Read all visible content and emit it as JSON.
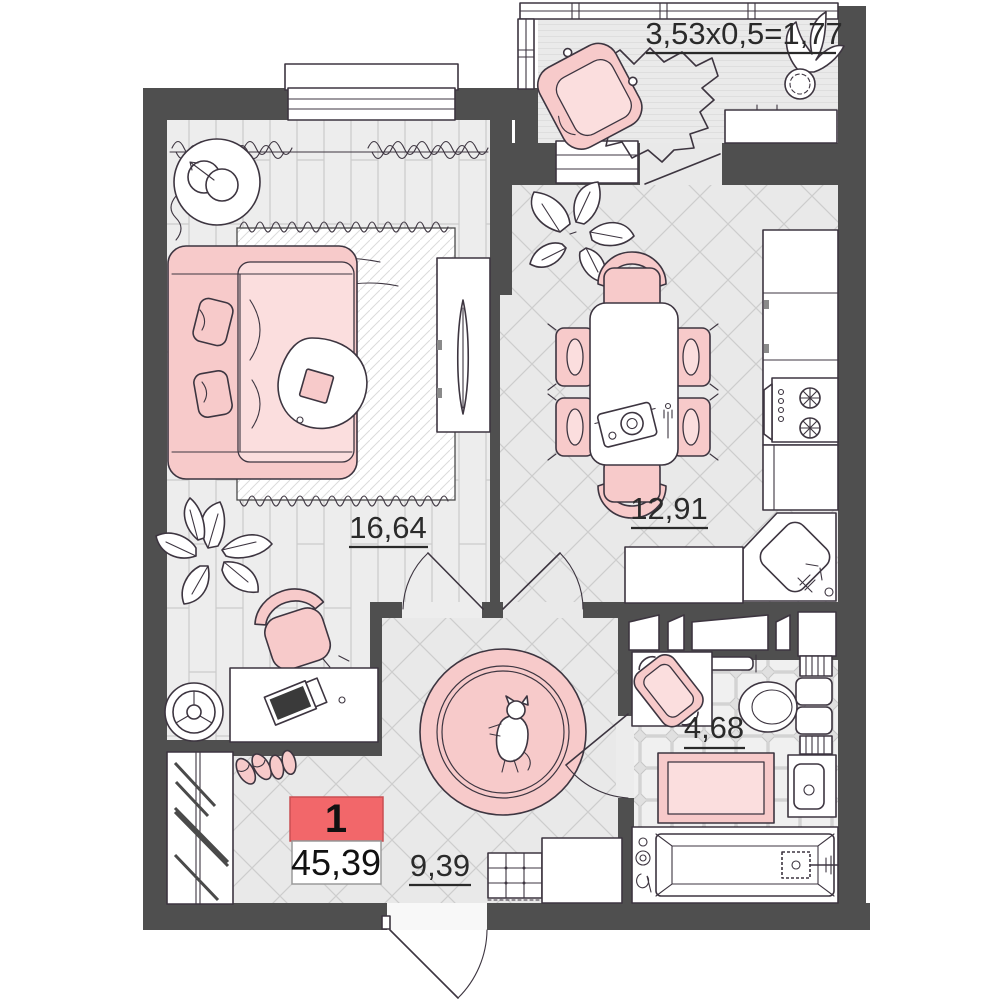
{
  "plan": {
    "badge": {
      "rooms": "1",
      "total_area": "45,39"
    },
    "labels": {
      "balcony_formula": "3,53x0,5=1,77",
      "living_area": "16,64",
      "kitchen_area": "12,91",
      "hall_area": "9,39",
      "bath_area": "4,68"
    },
    "colors": {
      "wall": "#4f4f4f",
      "pink": "#f7caca",
      "pink-light": "#fbdede",
      "badge-red": "#f2676a",
      "line": "#3d3540",
      "text": "#2a2a2a"
    }
  }
}
